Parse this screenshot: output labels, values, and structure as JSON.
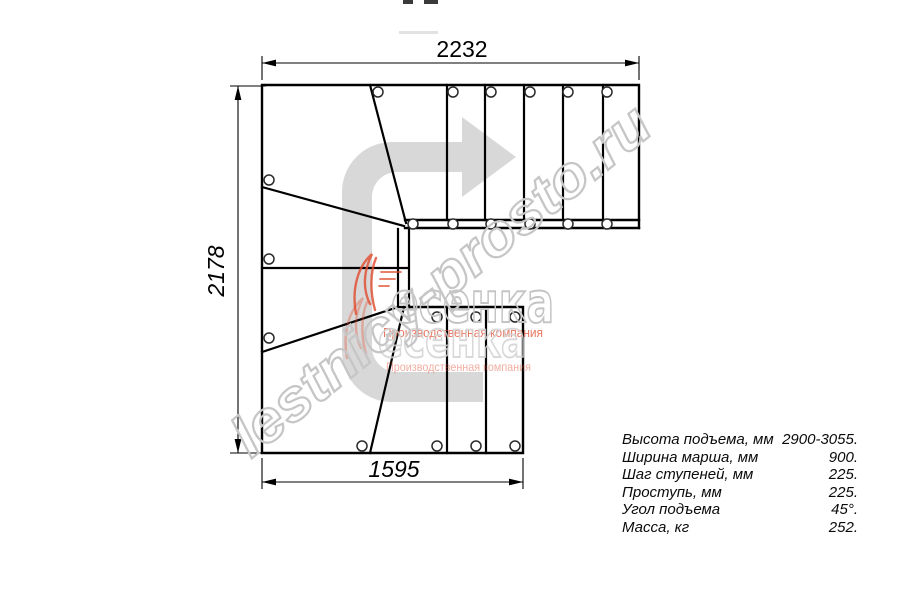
{
  "drawing": {
    "dimensions": {
      "top": "2232",
      "left": "2178",
      "bottom": "1595"
    }
  },
  "spec_table": {
    "rows": [
      {
        "label": "Высота подъема, мм",
        "value": "2900-3055."
      },
      {
        "label": "Ширина марша, мм",
        "value": "900."
      },
      {
        "label": "Шаг ступеней, мм",
        "value": "225."
      },
      {
        "label": "Проступь, мм",
        "value": "225."
      },
      {
        "label": "Угол подъема",
        "value": "45°."
      },
      {
        "label": "Масса, кг",
        "value": "252."
      }
    ]
  },
  "watermark": {
    "site": "lestnicy-prosto.ru",
    "logo_text": "есенка",
    "tagline": "Производственная компания"
  },
  "colors": {
    "line": "#000000",
    "arrow_fill": "#d8d8d8",
    "watermark_gray": "#c6c6c6",
    "logo_red": "#e14a2e"
  }
}
